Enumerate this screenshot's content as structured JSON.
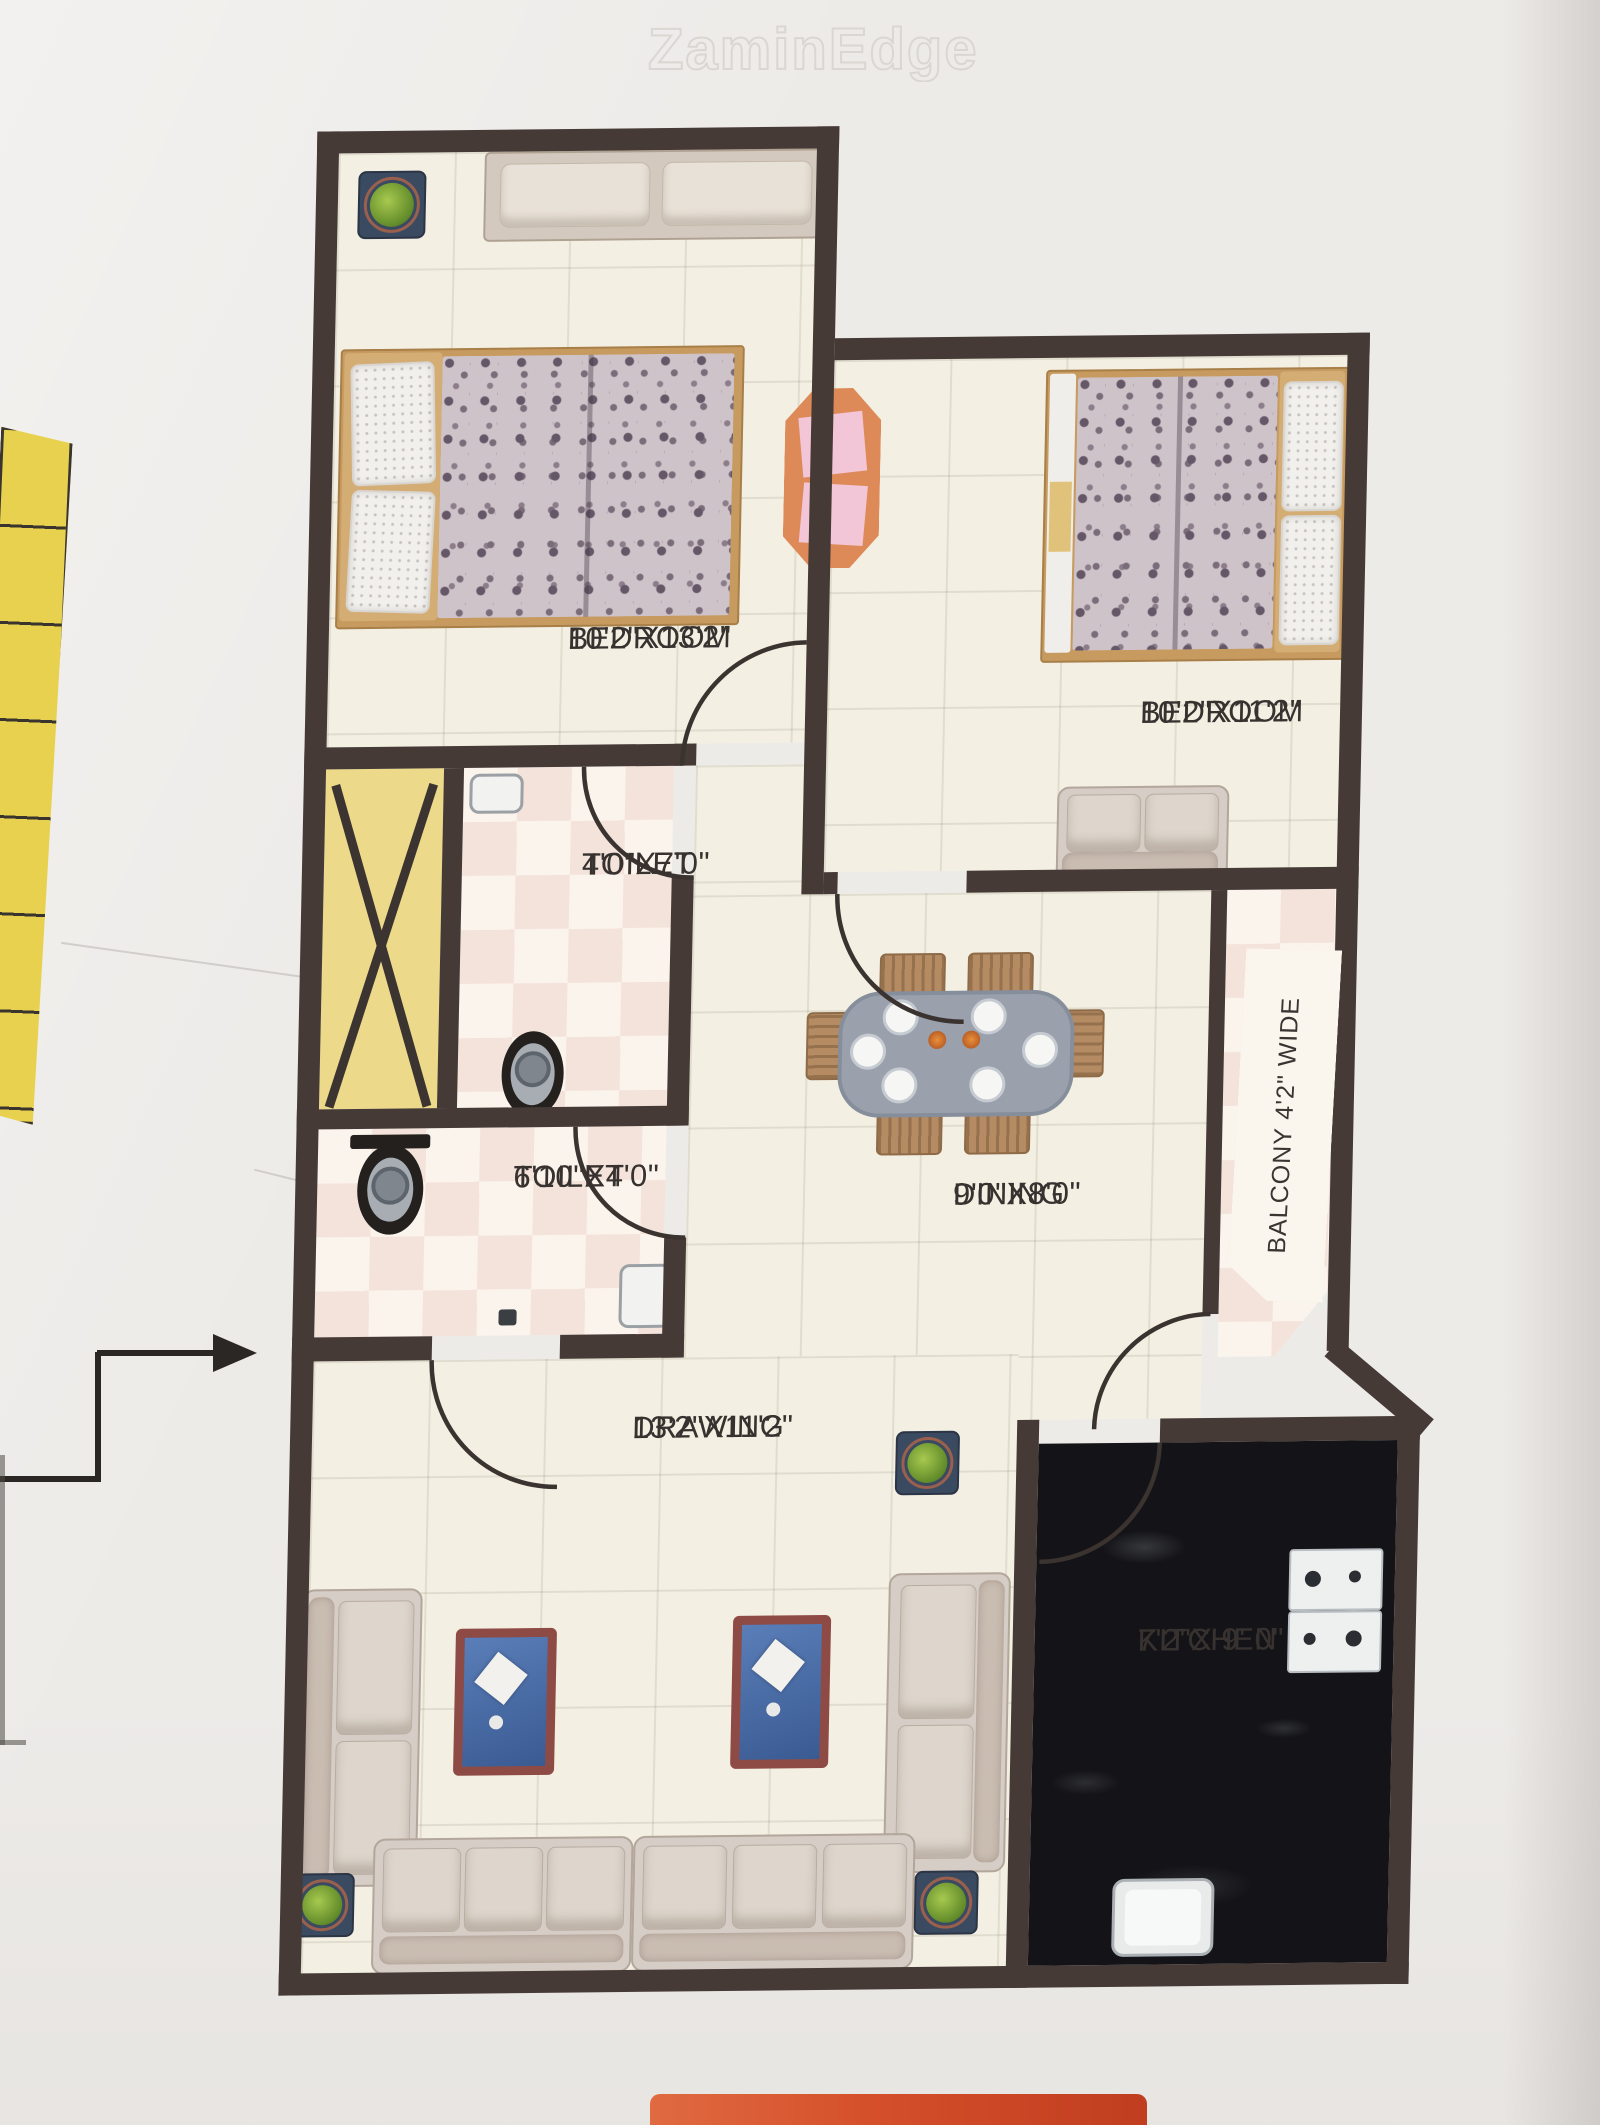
{
  "watermark": "ZaminEdge",
  "plan": {
    "rooms": {
      "bedroom1": {
        "name": "BEDROOM",
        "dims": "10'2\"X13'2\""
      },
      "bedroom2": {
        "name": "BEDROOM",
        "dims": "10'2\"X11'2\""
      },
      "toilet1": {
        "name": "TOILET",
        "dims": "4'0\"X7'0\""
      },
      "toilet2": {
        "name": "TOILET",
        "dims": "6'10\"X4'0\""
      },
      "dining": {
        "name": "DINING",
        "dims": "9'0\"X8'0\""
      },
      "drawing": {
        "name": "DRAWING",
        "dims": "13'2\"X11'2\""
      },
      "kitchen": {
        "name": "KITCHEN",
        "dims": "7'2\"X 9' 0\""
      },
      "balcony": {
        "label": "BALCONY 4'2\" WIDE"
      }
    },
    "colors": {
      "wall": "#463a37",
      "floor": "#f3f0e3",
      "tile_pink": "#f4e3db",
      "tile_cream": "#fbf4ed",
      "shaft_yellow": "#ecd98a",
      "stairs_yellow": "#e8d14f",
      "granite": "#141418",
      "red_strip": "#d44f2a"
    }
  }
}
